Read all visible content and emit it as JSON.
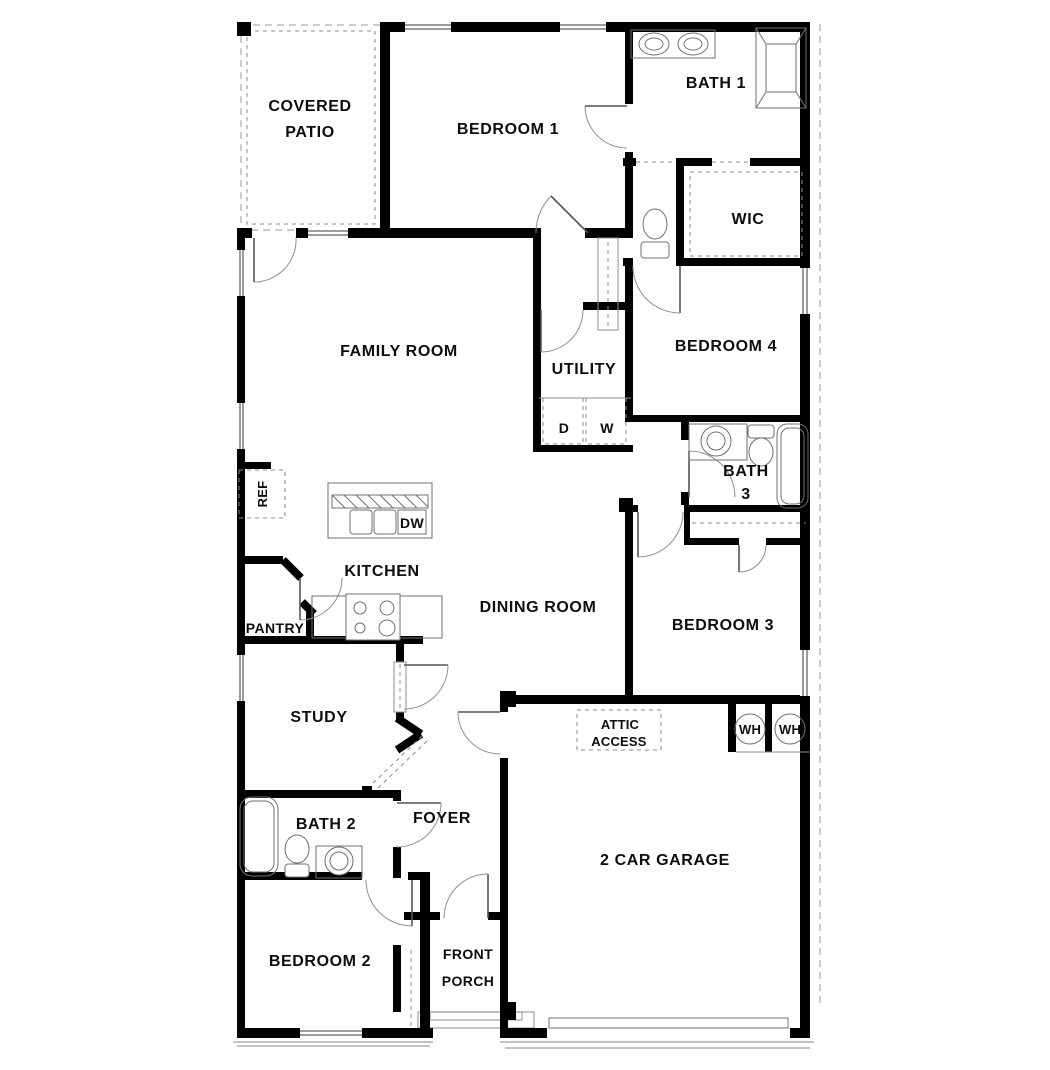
{
  "plan": {
    "background": "#ffffff",
    "wall_color": "#000000",
    "fixture_color": "#707070",
    "text_color": "#0d0d0d"
  },
  "rooms": {
    "covered_patio": {
      "line1": "COVERED",
      "line2": "PATIO"
    },
    "bedroom1": {
      "label": "BEDROOM 1"
    },
    "bath1": {
      "label": "BATH 1"
    },
    "wic": {
      "label": "WIC"
    },
    "family_room": {
      "label": "FAMILY ROOM"
    },
    "utility": {
      "label": "UTILITY"
    },
    "bedroom4": {
      "label": "BEDROOM 4"
    },
    "bath3": {
      "line1": "BATH",
      "line2": "3"
    },
    "kitchen": {
      "label": "KITCHEN"
    },
    "pantry": {
      "label": "PANTRY"
    },
    "dining": {
      "label": "DINING ROOM"
    },
    "bedroom3": {
      "label": "BEDROOM 3"
    },
    "study": {
      "label": "STUDY"
    },
    "foyer": {
      "label": "FOYER"
    },
    "bath2": {
      "label": "BATH 2"
    },
    "bedroom2": {
      "label": "BEDROOM 2"
    },
    "front_porch": {
      "line1": "FRONT",
      "line2": "PORCH"
    },
    "garage": {
      "label": "2 CAR GARAGE"
    },
    "attic": {
      "line1": "ATTIC",
      "line2": "ACCESS"
    }
  },
  "appliances": {
    "ref": "REF",
    "dw": "DW",
    "dryer": "D",
    "washer": "W",
    "wh1": "WH",
    "wh2": "WH"
  }
}
